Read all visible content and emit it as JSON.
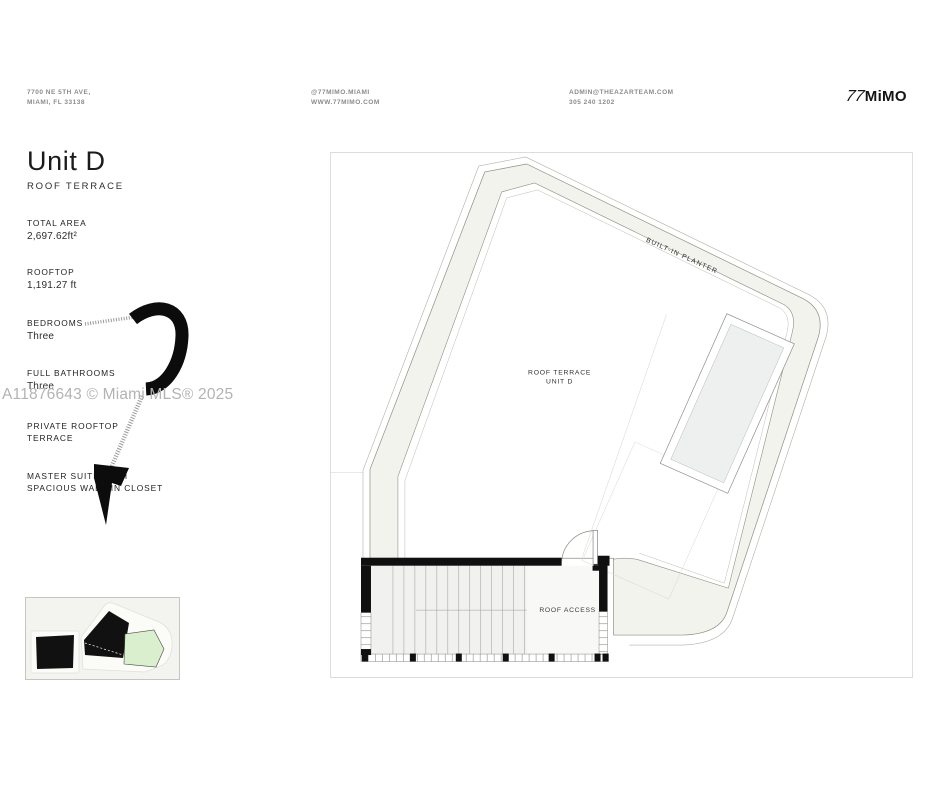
{
  "header": {
    "address_line1": "7700 NE 5TH AVE,",
    "address_line2": "MIAMI, FL 33138",
    "social_line1": "@77MIMO.MIAMI",
    "social_line2": "WWW.77MIMO.COM",
    "contact_line1": "ADMIN@THEAZARTEAM.COM",
    "contact_line2": "305 240 1202",
    "logo_prefix": "77",
    "logo_name": "MiMO"
  },
  "title": {
    "unit": "Unit D",
    "subtitle": "ROOF TERRACE"
  },
  "stats": [
    {
      "label": "TOTAL AREA",
      "value": "2,697.62ft²"
    },
    {
      "label": "ROOFTOP",
      "value": "1,191.27 ft"
    },
    {
      "label": "BEDROOMS",
      "value": "Three"
    },
    {
      "label": "FULL BATHROOMS",
      "value": "Three"
    },
    {
      "label": "PRIVATE ROOFTOP\nTERRACE",
      "value": ""
    },
    {
      "label": "MASTER SUITE WITH\nSPACIOUS WALK-IN CLOSET",
      "value": ""
    }
  ],
  "watermark": "A11876643 © Miami MLS® 2025",
  "floorplan": {
    "room_label_line1": "ROOF TERRACE",
    "room_label_line2": "UNIT D",
    "planter_label": "BUILT-IN PLANTER",
    "access_label": "ROOF ACCESS"
  },
  "colors": {
    "planter_fill": "#f3f3ed",
    "outline": "#8f8f87",
    "pool_fill": "#edf0ee",
    "wall_black": "#101010",
    "highlight_unit_green": "#d9efce",
    "watermark_gray": "#b3b3b3"
  }
}
